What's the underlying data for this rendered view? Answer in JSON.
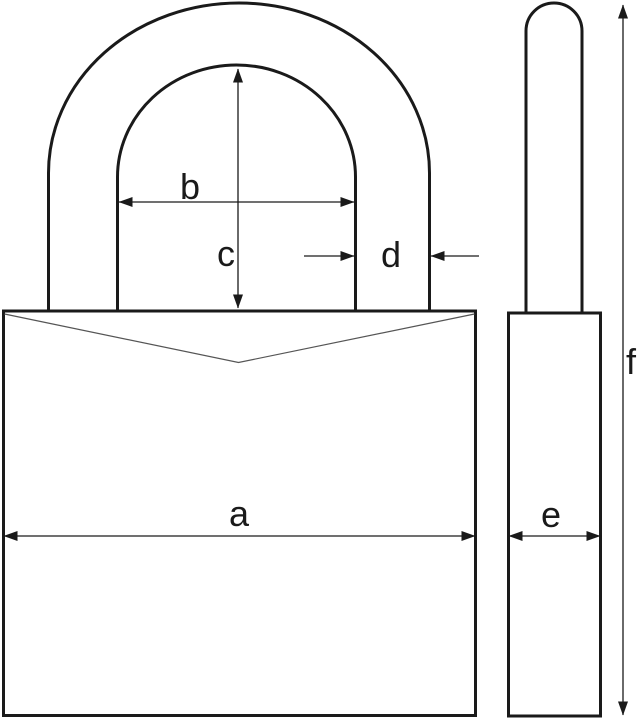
{
  "diagram": {
    "labels": {
      "a": "a",
      "b": "b",
      "c": "c",
      "d": "d",
      "e": "e",
      "f": "f"
    },
    "colors": {
      "outline": "#1a1a1a",
      "notch_line": "#555555",
      "dimension_line": "#1a1a1a",
      "background": "#ffffff"
    }
  }
}
